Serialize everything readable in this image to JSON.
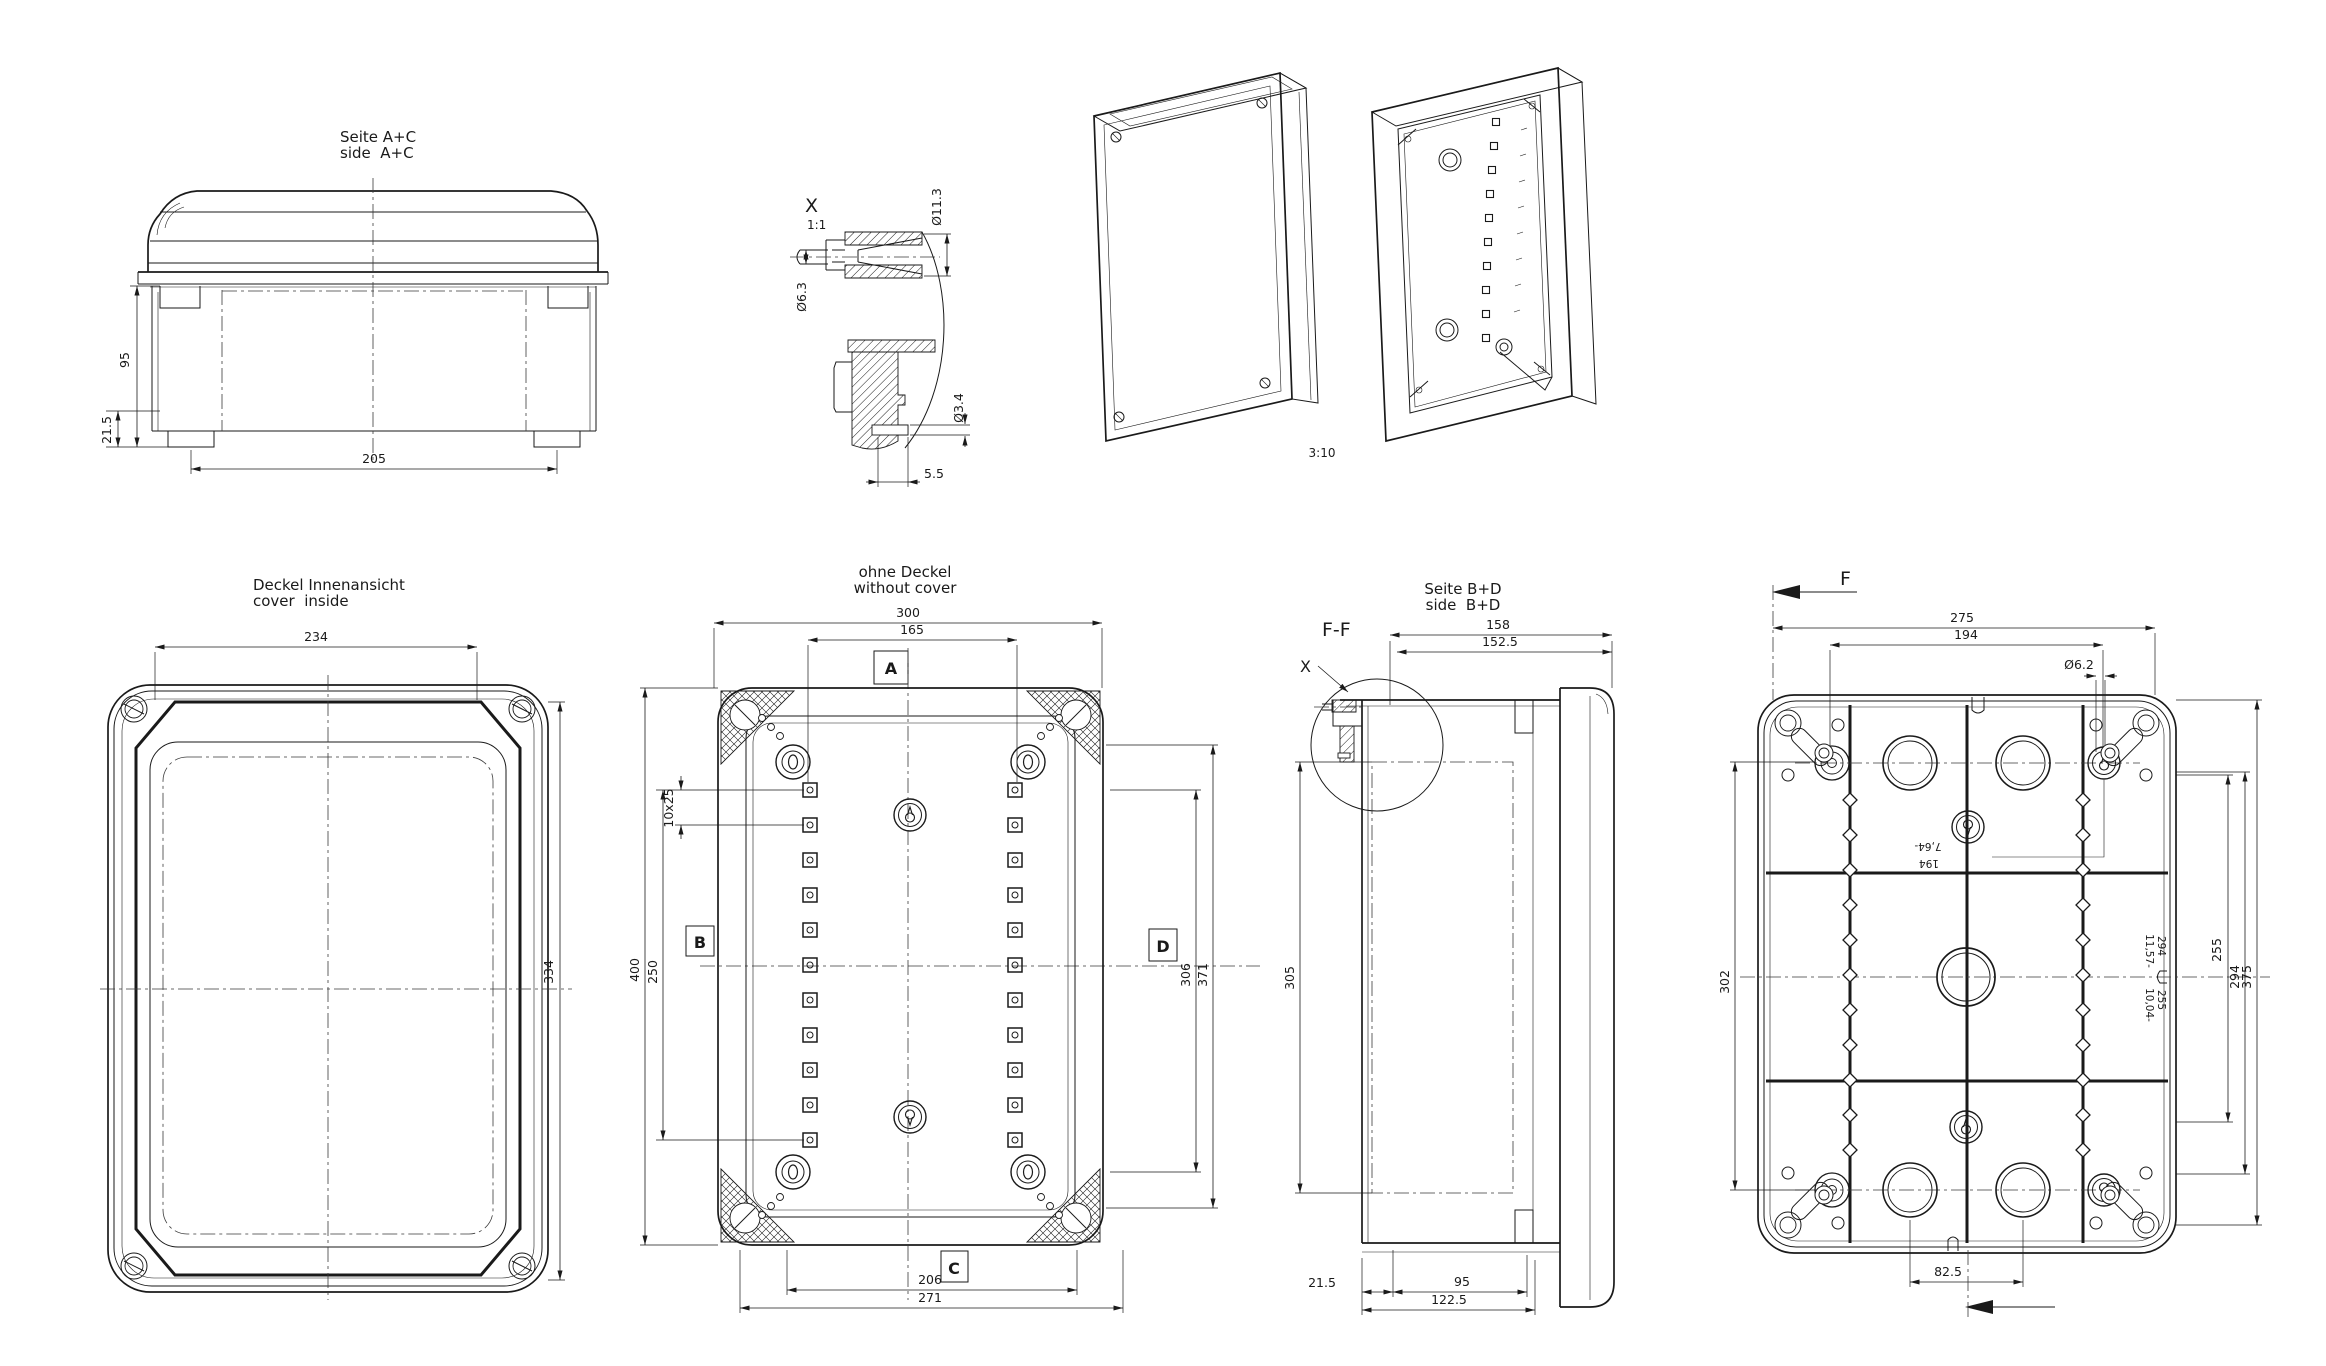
{
  "views": {
    "side_ac": {
      "title_de": "Seite A+C",
      "title_en": "side  A+C",
      "dim_height": "95",
      "dim_foot": "21.5",
      "dim_feet_spacing": "205"
    },
    "detail_x": {
      "label": "X",
      "scale": "1:1",
      "dia_outer": "Ø11.3",
      "dia_pin": "Ø6.3",
      "dia_hole": "Ø3.4",
      "dim_depth": "5.5"
    },
    "isometric": {
      "scale": "3:10"
    },
    "cover_inside": {
      "title_de": "Deckel Innenansicht",
      "title_en": "cover  inside",
      "dim_width": "234",
      "dim_height": "334"
    },
    "without_cover": {
      "title_de": "ohne Deckel",
      "title_en": "without cover",
      "label_a": "A",
      "label_b": "B",
      "label_c": "C",
      "label_d": "D",
      "dim_outer_w": "300",
      "dim_boss_w": "165",
      "dim_outer_h": "400",
      "dim_boss_h": "250",
      "dim_pitch": "10x25",
      "dim_right_inner": "306",
      "dim_right_outer": "371",
      "dim_bottom_inner": "206",
      "dim_bottom_outer": "271"
    },
    "side_bd": {
      "title_de": "Seite B+D",
      "title_en": "side  B+D",
      "section_label": "F-F",
      "detail_label": "X",
      "dim_top_outer": "158",
      "dim_top_inner": "152.5",
      "dim_height": "305",
      "dim_foot": "21.5",
      "dim_body": "95",
      "dim_total": "122.5"
    },
    "bottom": {
      "section_label": "F",
      "dim_top_outer": "275",
      "dim_top_inner": "194",
      "dia_hole": "Ø6.2",
      "dim_left": "302",
      "dim_bottom": "82.5",
      "dim_right_inner": "255",
      "dim_right_mid": "294",
      "dim_right_outer": "375",
      "emboss_mm_1": "194",
      "emboss_in_1": "7,64-",
      "emboss_mm_2": "294",
      "emboss_in_2": "11,57-",
      "emboss_mm_3": "255",
      "emboss_in_3": "10,04-"
    }
  }
}
